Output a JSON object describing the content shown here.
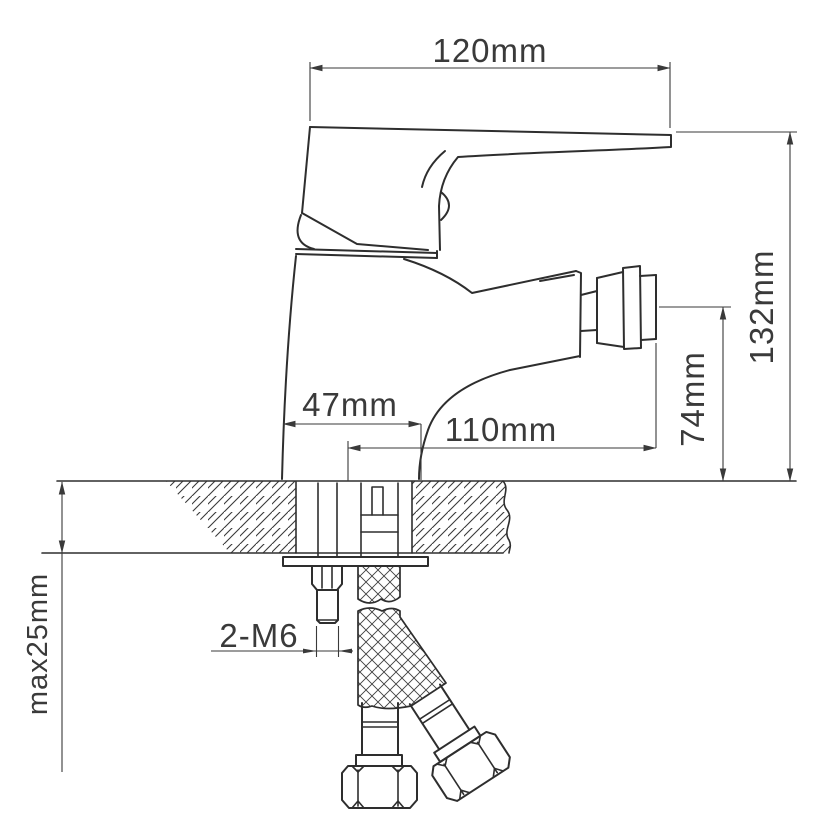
{
  "page": {
    "background": "#ffffff",
    "line_color": "#2e2e2e",
    "dimension_color": "#3a3a3a"
  },
  "drawing": {
    "type": "technical-drawing",
    "subject": "single-handle bidet mixer faucet, side elevation with deck cross-section, mounting stud and braided supply hoses",
    "dimensions": {
      "overall_width": "120mm",
      "overall_height": "132mm",
      "outlet_height": "74mm",
      "body_depth": "47mm",
      "outlet_reach": "110mm",
      "mounting_thread": "2-M6",
      "max_deck_thickness": "max25mm"
    }
  }
}
